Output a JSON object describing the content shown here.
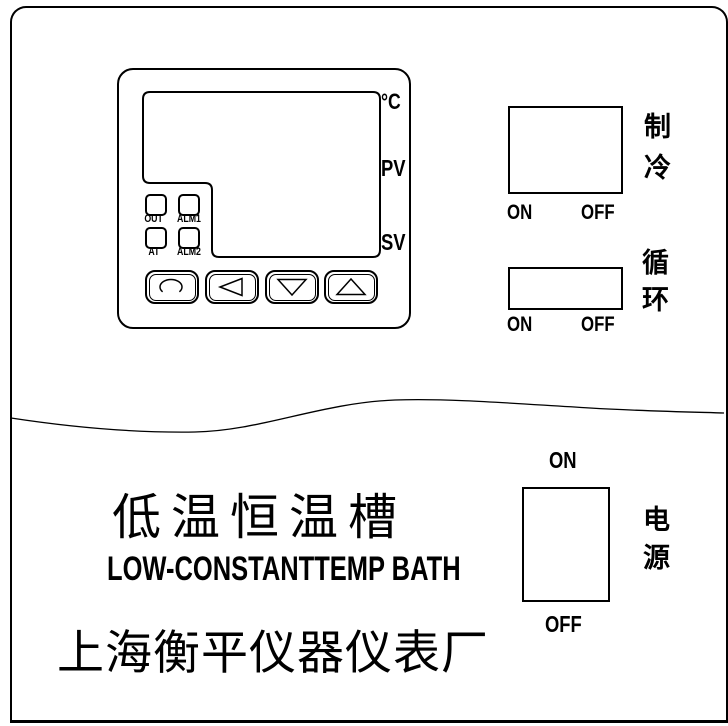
{
  "controller": {
    "unit_label": "°C",
    "pv_label": "PV",
    "sv_label": "SV",
    "indicators": [
      {
        "label": "OUT"
      },
      {
        "label": "ALM1"
      },
      {
        "label": "AT"
      },
      {
        "label": "ALM2"
      }
    ],
    "keys": [
      {
        "icon": "loop"
      },
      {
        "icon": "arrow-left"
      },
      {
        "icon": "arrow-down"
      },
      {
        "icon": "arrow-up"
      }
    ]
  },
  "switches": {
    "cooling": {
      "name": "制冷",
      "chars": [
        "制",
        "冷"
      ],
      "on_label": "ON",
      "off_label": "OFF"
    },
    "circulation": {
      "name": "循环",
      "chars": [
        "循",
        "环"
      ],
      "on_label": "ON",
      "off_label": "OFF"
    },
    "power": {
      "name": "电源",
      "chars": [
        "电",
        "源"
      ],
      "on_label": "ON",
      "off_label": "OFF"
    }
  },
  "branding": {
    "product_name_zh": "低温恒温槽",
    "product_name_en": "LOW-CONSTANTTEMP BATH",
    "manufacturer_zh": "上海衡平仪器仪表厂"
  },
  "colors": {
    "line": "#000000",
    "background": "#ffffff"
  }
}
